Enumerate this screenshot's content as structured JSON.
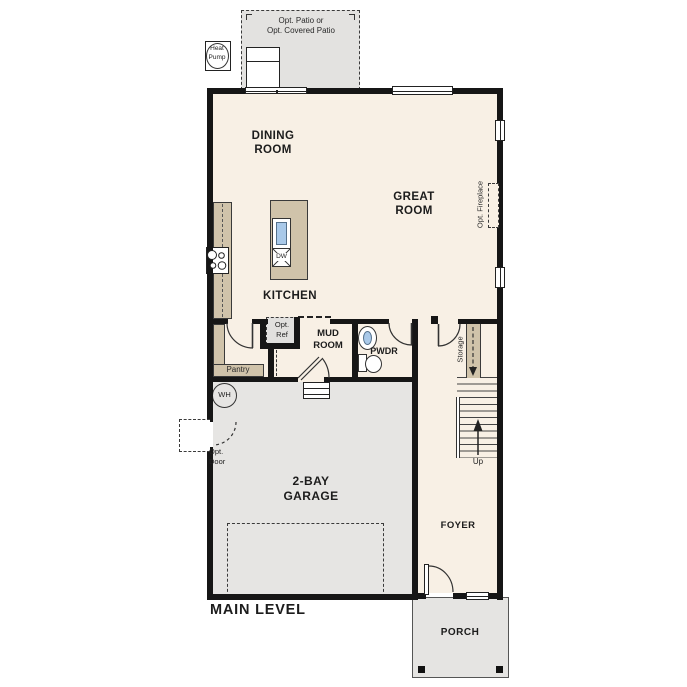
{
  "title": "MAIN LEVEL",
  "rooms": {
    "dining": "DINING\nROOM",
    "great": "GREAT\nROOM",
    "kitchen": "KITCHEN",
    "mud": "MUD\nROOM",
    "pwdr": "PWDR",
    "pantry": "Pantry",
    "garage": "2-BAY\nGARAGE",
    "foyer": "FOYER",
    "porch": "PORCH"
  },
  "annotations": {
    "patio": "Opt. Patio or\nOpt. Covered Patio",
    "heat_pump": "Heat\nPump",
    "water_heater": "WH",
    "opt_ref": "Opt.\nRef",
    "opt_door": "Opt.\nDoor",
    "opt_fireplace": "Opt. Fireplace",
    "storage": "Storage",
    "stairs_up": "Up",
    "dishwasher": "DW"
  },
  "colors": {
    "wall": "#161616",
    "floor": "#f8f0e5",
    "garage_floor": "#e6e5e3",
    "patio": "#e3e2e0",
    "counter_tan": "#d0c3aa",
    "sink_blue": "#a9c9e9"
  }
}
